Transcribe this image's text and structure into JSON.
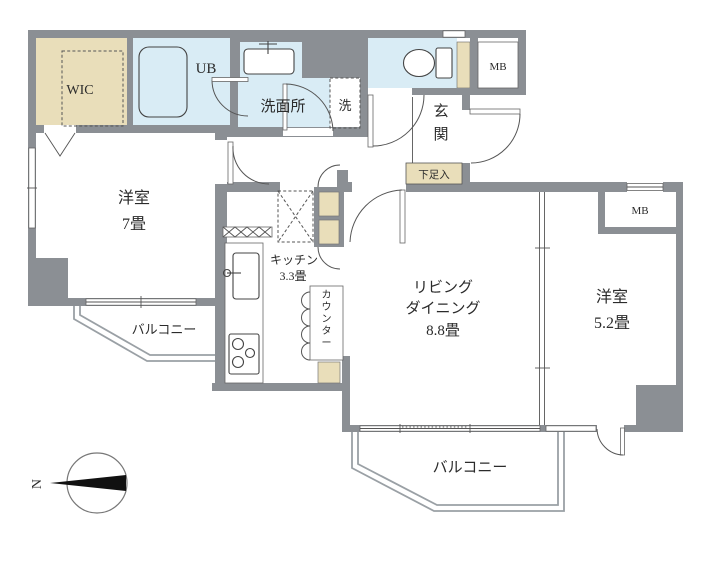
{
  "rooms": {
    "wic": {
      "label": "WIC"
    },
    "unit_bath": {
      "label": "UB"
    },
    "washroom": {
      "label": "洗面所"
    },
    "washing_machine": {
      "label": "洗"
    },
    "meter_box_top": {
      "label": "MB"
    },
    "entrance": {
      "label": "玄関"
    },
    "shoe_cabinet": {
      "label": "下足入"
    },
    "bedroom_west": {
      "label_line1": "洋室",
      "label_line2": "7畳"
    },
    "kitchen": {
      "label_line1": "キッチン",
      "label_line2": "3.3畳"
    },
    "counter": {
      "label": "カウンター"
    },
    "living_dining": {
      "label_line1": "リビング",
      "label_line2": "ダイニング",
      "label_line3": "8.8畳"
    },
    "bedroom_east": {
      "label_line1": "洋室",
      "label_line2": "5.2畳"
    },
    "meter_box_right": {
      "label": "MB"
    },
    "balcony_west": {
      "label": "バルコニー"
    },
    "balcony_south": {
      "label": "バルコニー"
    }
  },
  "compass": {
    "north": "N"
  },
  "colors": {
    "wall": "#8b8f94",
    "room_beige": "#e9deba",
    "room_blue": "#d9ecf5",
    "line": "#555555",
    "balcony_line": "#9aa0a5",
    "needle": "#111111"
  }
}
